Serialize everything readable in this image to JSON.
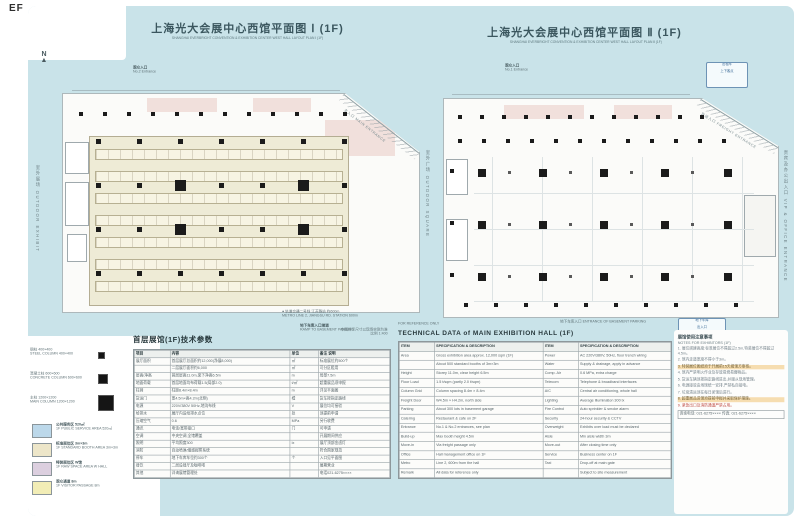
{
  "page": {
    "corner_label": "EF"
  },
  "sheets": {
    "left": {
      "title": "上海光大会展中心西馆平面图 Ⅰ (1F)",
      "subtitle": "SHANGHAI EVERBRIGHT CONVENTION & EXHIBITION CENTER  WEST HALL LAYOUT PLAN Ⅰ (1F)",
      "entrance_cn": "观众入口",
      "entrance_en": "No.2 Entrance",
      "corner_label": "主入口 MAIN ENTRANCE",
      "side_label": "室外展场 OUTDOOR EXHIBIT",
      "north_label": "N",
      "note1": "● 轨道交通二号线 江苏路站 约600m",
      "note2": "METRO LINE 2, JIANGSU RD. STATION 600m",
      "note3": "地下车库入口坡道",
      "note4": "RAMP TO BASEMENT PARKING"
    },
    "right": {
      "title": "上海光大会展中心西馆平面图 Ⅱ (1F)",
      "subtitle": "SHANGHAI EVERBRIGHT CONVENTION & EXHIBITION CENTER  WEST HALL LAYOUT PLAN Ⅱ (1F)",
      "entrance_cn": "观众入口",
      "entrance_en": "No.1 Entrance",
      "corner_label": "货运入口 FREIGHT ENTRANCE",
      "mid_label": "室外广场 OUTDOOR SQUARE",
      "side_label": "贵宾及办公出入口 VIP & OFFICE ENTRANCE",
      "note1": "地下车库入口 ENTRANCE OF BASEMENT PARKING",
      "badge_top": [
        "出租车",
        "上下客点"
      ],
      "badge_bottom": [
        "地下车库",
        "出入口",
        "限高2.2m"
      ]
    }
  },
  "plans": {
    "left": {
      "booth_rows": 7,
      "grid_cols": 7,
      "grid_rows": 4,
      "lobby_columns": 12,
      "big_columns": [
        [
          2,
          1
        ],
        [
          5,
          1
        ],
        [
          2,
          2
        ],
        [
          5,
          2
        ]
      ]
    },
    "right": {
      "grid_cols": 5,
      "grid_rows": 3,
      "top_row_columns": 12,
      "second_row_columns": 12,
      "bottom_row_columns": 10,
      "left_edge_columns": 3
    }
  },
  "symbol_legend": {
    "items": [
      {
        "size": 5,
        "line1": "钢柱 400×400",
        "line2": "STEEL COLUMN 400×400"
      },
      {
        "size": 8,
        "line1": "混凝土柱 600×600",
        "line2": "CONCRETE COLUMN 600×600"
      },
      {
        "size": 14,
        "line1": "主柱 1200×1200",
        "line2": "MAIN COLUMN 1200×1200"
      }
    ]
  },
  "color_legend": {
    "items": [
      {
        "color": "#bcd8ea",
        "line1": "公共服务区 520㎡",
        "line2": "1F PUBLIC SERVICE AREA 520㎡"
      },
      {
        "color": "#ede6c9",
        "line1": "标准展位区 3m×3m",
        "line2": "1F STANDARD BOOTH AREA 3m×3m"
      },
      {
        "color": "#dccfdf",
        "line1": "特装展位区 W馆",
        "line2": "1F RAW SPACE AREA W HALL"
      },
      {
        "color": "#f2edb6",
        "line1": "观众通道 8m",
        "line2": "1F VISITOR PASSAGE 8m"
      }
    ]
  },
  "left_table": {
    "title": "首层展馆(1F)技术参数",
    "note1": "本图所示尺寸以现场实测为准",
    "note2": "比例 1:400",
    "headers": [
      "项目",
      "内容",
      "单位",
      "备注 说明"
    ],
    "rows": [
      [
        "展厅面积",
        "首层展厅总面积约12,000(净展8,000)",
        "㎡",
        "标准展位约500个"
      ],
      [
        "",
        "二层展厅面积约6,000",
        "㎡",
        "可分区租用"
      ],
      [
        "层高/净高",
        "首层层高11.0m,梁下净高6.5m",
        "m",
        "局部7.5m"
      ],
      [
        "地面荷载",
        "首层地面均布荷载1.5(局部2.0)",
        "t/㎡",
        "超重展品须申报"
      ],
      [
        "柱网",
        "柱距8.4m×8.4m",
        "m",
        "详见平面图"
      ],
      [
        "货运门",
        "宽4.5m×高4.2m(北侧)",
        "樘",
        "货车按指定路线"
      ],
      [
        "电源",
        "220V/380V 50Hz,地沟布线",
        "V",
        "展位均可接驳"
      ],
      [
        "给排水",
        "展厅内设给排水点位",
        "处",
        "须提前申请"
      ],
      [
        "压缩空气",
        "0.6",
        "MPa",
        "另行收费"
      ],
      [
        "通讯",
        "电话/宽带接口",
        "门",
        "可申请"
      ],
      [
        "空调",
        "中央空调,全馆覆盖",
        "",
        "开展期间供应"
      ],
      [
        "照明",
        "平均照度300",
        "lx",
        "展厅顶部金卤灯"
      ],
      [
        "消防",
        "自动喷淋/烟感报警系统",
        "",
        "符合国家规范"
      ],
      [
        "停车",
        "地下车库车位约300个",
        "个",
        "入口见平面图"
      ],
      [
        "餐饮",
        "二层设餐厅及咖啡吧",
        "",
        "展期营业"
      ],
      [
        "其他",
        "详询展馆管理处",
        "",
        "电话021-6275××××"
      ]
    ]
  },
  "right_table": {
    "title": "TECHNICAL DATA of MAIN EXHIBITION HALL (1F)",
    "note1": "FOR REFERENCE ONLY",
    "headers": [
      "ITEM",
      "SPECIFICATION & DESCRIPTION",
      "ITEM",
      "SPECIFICATION & DESCRIPTION"
    ],
    "rows": [
      [
        "Area",
        "Gross exhibition area approx. 12,000 sqm (1F)",
        "Power",
        "AC 220V/380V, 50Hz, floor trench wiring"
      ],
      [
        "",
        "About 500 standard booths of 3m×3m",
        "Water",
        "Supply & drainage, apply in advance"
      ],
      [
        "Height",
        "Storey 11.0m, clear height 6.5m",
        "Comp. Air",
        "0.6 MPa, extra charge"
      ],
      [
        "Floor Load",
        "1.5 t/sqm (partly 2.0 t/sqm)",
        "Telecom",
        "Telephone & broadband interfaces"
      ],
      [
        "Column Grid",
        "Column spacing 8.4m × 8.4m",
        "A/C",
        "Central air conditioning, whole hall"
      ],
      [
        "Freight Door",
        "W4.5m × H4.2m, north side",
        "Lighting",
        "Average illumination 300 lx"
      ],
      [
        "Parking",
        "About 300 lots in basement garage",
        "Fire Control",
        "Auto sprinkler & smoke alarm"
      ],
      [
        "Catering",
        "Restaurant & cafe on 2F",
        "Security",
        "24-hour security & CCTV"
      ],
      [
        "Entrance",
        "No.1 & No.2 entrances, see plan",
        "Overweight",
        "Exhibits over load must be declared"
      ],
      [
        "Build-up",
        "Max booth height 4.5m",
        "Aisle",
        "Min aisle width 3m"
      ],
      [
        "Move-in",
        "Via freight passage only",
        "Move-out",
        "After closing time only"
      ],
      [
        "Office",
        "Hall management office on 1F",
        "Service",
        "Business center on 1F"
      ],
      [
        "Metro",
        "Line 2, 600m from the hall",
        "Taxi",
        "Drop-off at main gate"
      ],
      [
        "Remark",
        "All data for reference only",
        "",
        "Subject to site measurement"
      ]
    ]
  },
  "notes_panel": {
    "heading1": "展馆使用注意事项",
    "heading2": "NOTES FOR EXHIBITORS (1F)",
    "items": [
      {
        "t": "1. 展位搭建高度:标准展位不得超过2.5m,特装展位不得超过4.5m。",
        "s": "n"
      },
      {
        "t": "2. 馆内走道宽度不得小于3m。",
        "s": "n"
      },
      {
        "t": "3. 特装展位图纸须于开展前15天报馆方审核。",
        "s": "h"
      },
      {
        "t": "4. 馆内严禁明火作业及存放易燃易爆物品。",
        "s": "n"
      },
      {
        "t": "5. 货运车辆须按指定路线进出,并服从现场管理。",
        "s": "n"
      },
      {
        "t": "6. 电源接驳由场馆统一安排,严禁私自接电。",
        "s": "n"
      },
      {
        "t": "7. 垃圾清运须在每日闭馆后进行。",
        "s": "n"
      },
      {
        "t": "8. 超重展品进馆须提前申报并采取保护措施。",
        "s": "h"
      },
      {
        "t": "9. 紧急出口及消防通道严禁占用。",
        "s": "r"
      },
      {
        "t": "咨询电话: 021-6275××××  传真: 021-6275××××",
        "s": "b"
      }
    ]
  }
}
